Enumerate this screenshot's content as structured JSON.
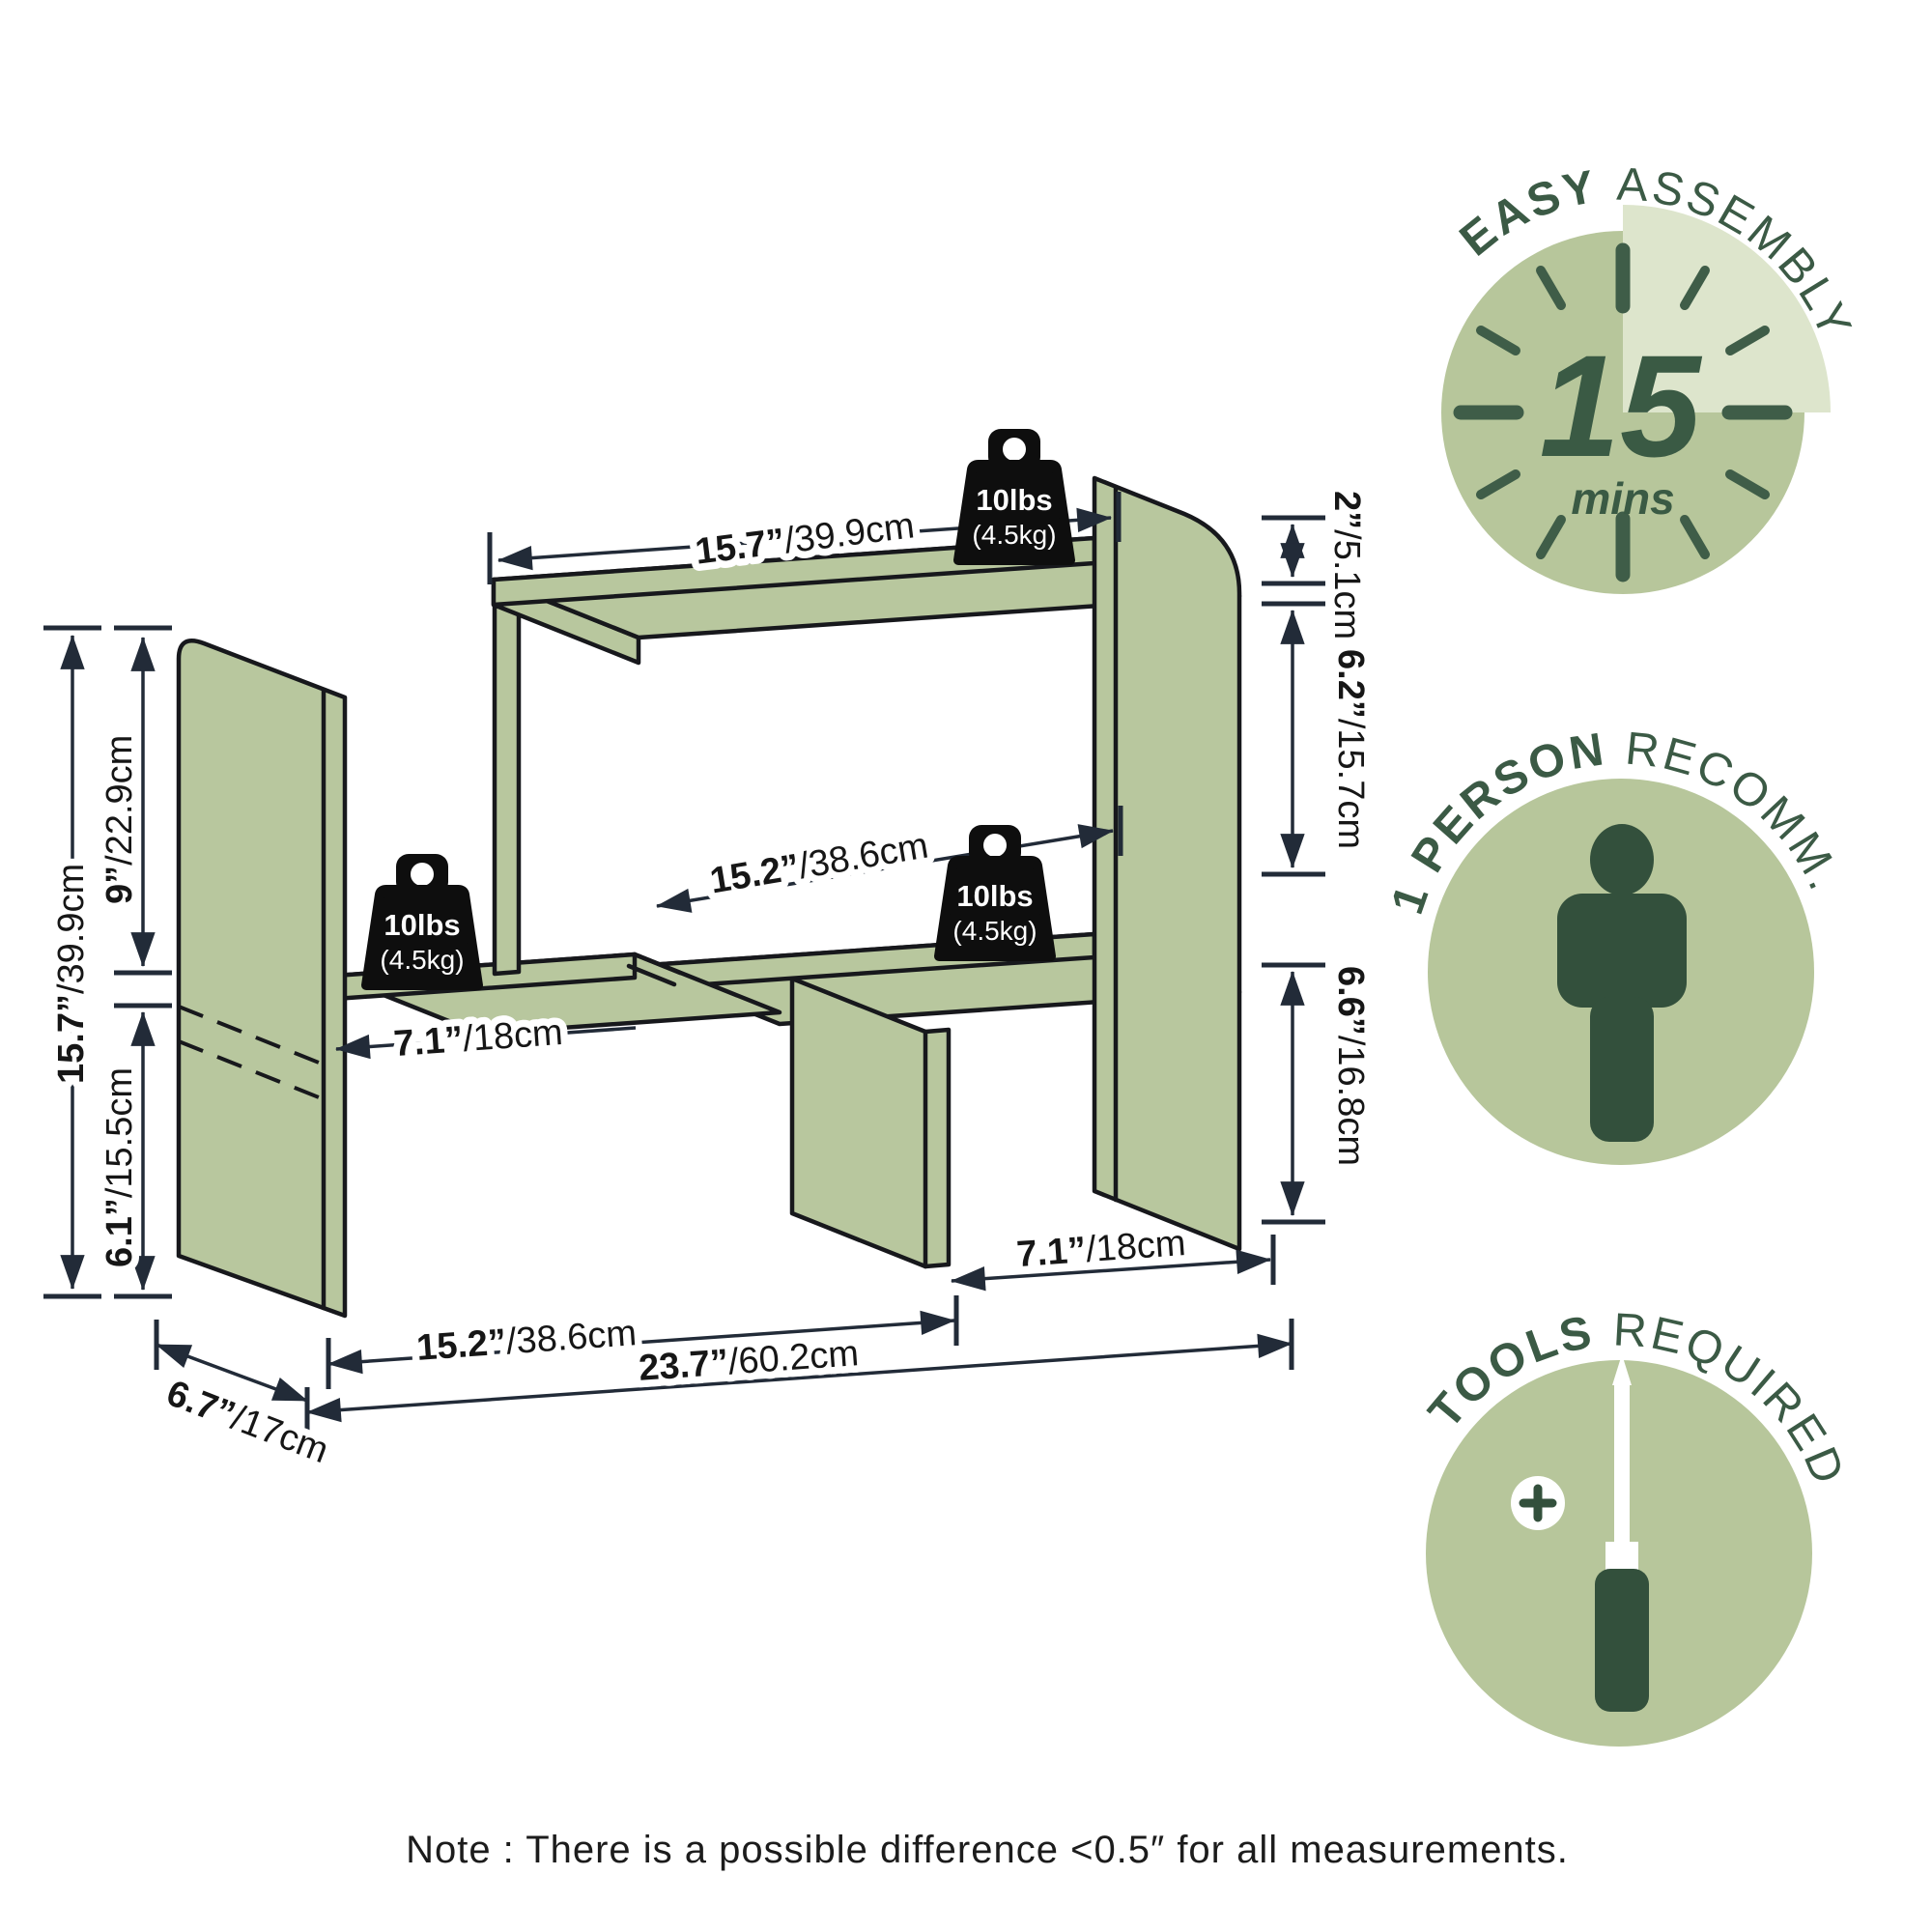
{
  "colors": {
    "shelf_green": "#b8c79e",
    "outline": "#17181c",
    "dim": "#222b38",
    "badge_green": "#b7c69b",
    "badge_pale": "#dde5cc",
    "badge_text": "#3b5a45",
    "icon_green": "#33503c",
    "weight_black": "#0e0e0e"
  },
  "diagram": {
    "weights": {
      "value": "10lbs",
      "metric": "(4.5kg)"
    },
    "dimensions": {
      "top_shelf_length": {
        "in": "15.7”",
        "cm": "/39.9cm"
      },
      "right_top_offset": {
        "in": "2”",
        "cm": "/5.1cm"
      },
      "upper_opening_height": {
        "in": "6.2”",
        "cm": "/15.7cm"
      },
      "middle_opening_width": {
        "in": "15.2”",
        "cm": "/38.6cm"
      },
      "lower_opening_height": {
        "in": "6.6”",
        "cm": "/16.8cm"
      },
      "total_height": {
        "in": "15.7”",
        "cm": "/39.9cm"
      },
      "upper_left_height": {
        "in": "9”",
        "cm": "/22.9cm"
      },
      "lower_left_height": {
        "in": "6.1”",
        "cm": "/15.5cm"
      },
      "depth": {
        "in": "6.7”",
        "cm": "/17cm"
      },
      "left_shelf_length": {
        "in": "7.1”",
        "cm": "/18cm"
      },
      "bottom_opening_width": {
        "in": "15.2”",
        "cm": "/38.6cm"
      },
      "total_width": {
        "in": "23.7”",
        "cm": "/60.2cm"
      },
      "right_leg_offset": {
        "in": "7.1”",
        "cm": "/18cm"
      }
    }
  },
  "badges": {
    "easy_assembly": {
      "title_bold": "EASY",
      "title_regular": "ASSEMBLY",
      "duration": "15",
      "duration_unit": "mins"
    },
    "one_person": {
      "title_bold": "1 PERSON",
      "title_regular": "RECOMM."
    },
    "tools_required": {
      "title_bold": "TOOLS",
      "title_regular": "REQUIRED"
    }
  },
  "note": "Note : There is a possible difference <0.5″ for all measurements."
}
